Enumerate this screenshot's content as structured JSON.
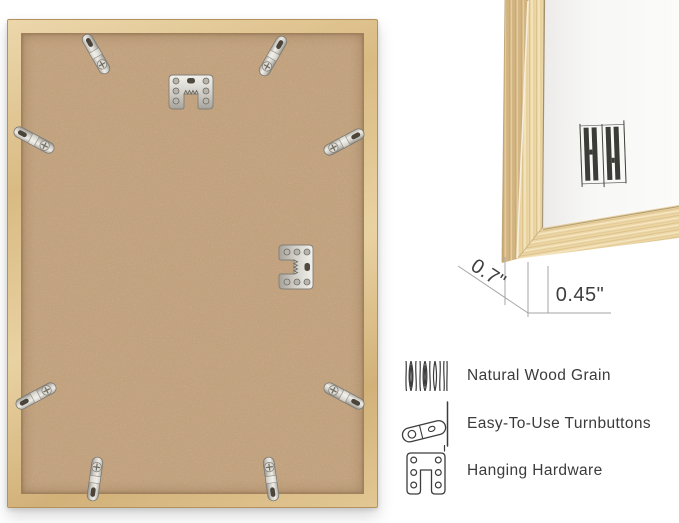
{
  "canvas": {
    "width": 679,
    "height": 523,
    "background": "#ffffff"
  },
  "back_view": {
    "subject": "picture frame back panel",
    "hardware": {
      "turnbutton_count": 8,
      "sawtooth_hanger_count": 2
    },
    "colors": {
      "wood_frame": "#ddbf8c",
      "backing_board": "#c4a481",
      "metal_hardware": "#d9d8d2"
    }
  },
  "corner_view": {
    "subject": "frame corner close-up with thickness measurements",
    "logo_icon": "hh-monogram-logo",
    "dimensions": [
      {
        "name": "frame-side-depth",
        "label": "0.7\""
      },
      {
        "name": "frame-face-width",
        "label": "0.45\""
      }
    ],
    "colors": {
      "wood_face": "#ecd6a6",
      "wood_side": "#d6b987",
      "picture_surface": "#f7f7f5",
      "logo": "#3b3b37"
    }
  },
  "features": [
    {
      "icon": "wood-grain-icon",
      "label": "Natural Wood Grain"
    },
    {
      "icon": "turnbutton-icon",
      "label": "Easy-To-Use Turnbuttons"
    },
    {
      "icon": "hanging-hardware-icon",
      "label": "Hanging Hardware"
    }
  ]
}
